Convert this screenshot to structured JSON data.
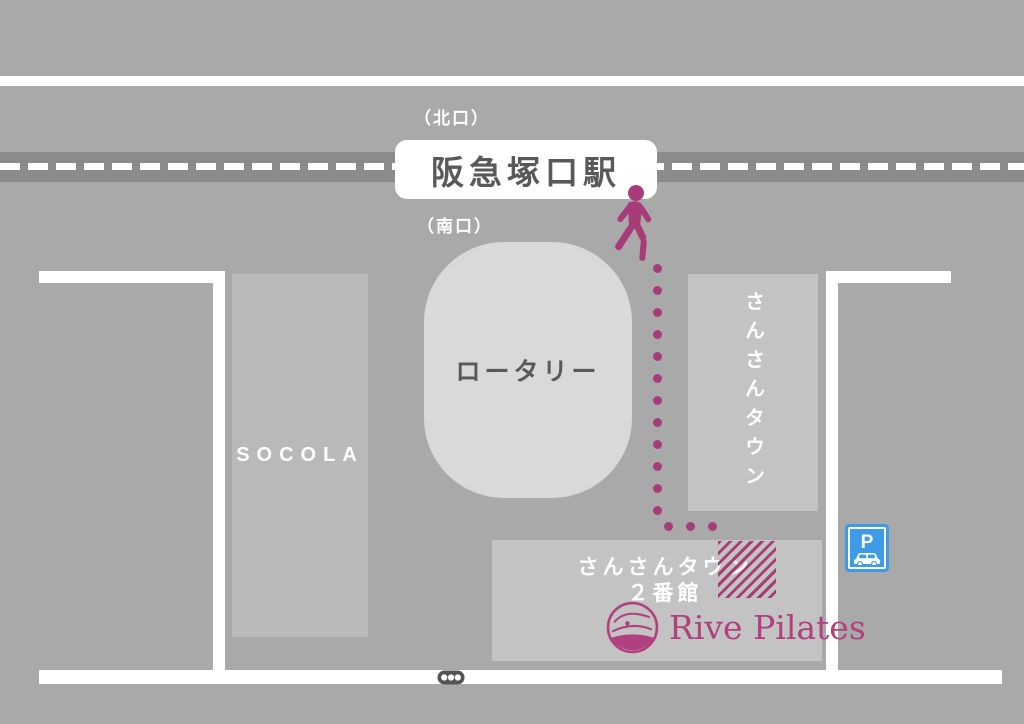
{
  "title": "Access map: Rive Pilates at Hankyu Tsukaguchi Station",
  "colors": {
    "bg": "#a9a9a9",
    "rail-band": "#8b8b8b",
    "road-white": "#ffffff",
    "rotary-fill": "#d9d9d9",
    "socola-fill": "#b9b9b9",
    "building-fill": "#c3c3c3",
    "accent": "#a63d78",
    "logo": "#b1407f",
    "text-dark": "#595959",
    "text-white": "#ffffff",
    "parking-blue": "#3e9be7",
    "signal-dark": "#555555"
  },
  "station": {
    "name": "阪急塚口駅",
    "north_exit": "（北口）",
    "south_exit": "（南口）"
  },
  "places": {
    "rotary": "ロータリー",
    "socola": "SOCOLA",
    "sansan_town": "さんさんタウン",
    "bldg2_line1": "さんさんタウン",
    "bldg2_line2": "２番館"
  },
  "logo": {
    "text": "Rive Pilates"
  },
  "parking": {
    "label": "P"
  },
  "route": {
    "dot_size": 9,
    "vertical": {
      "x": 657,
      "y_start": 268,
      "spacing": 22,
      "count": 12
    },
    "horizontal": {
      "y": 526,
      "x_start": 668,
      "spacing": 22,
      "count": 3
    }
  }
}
